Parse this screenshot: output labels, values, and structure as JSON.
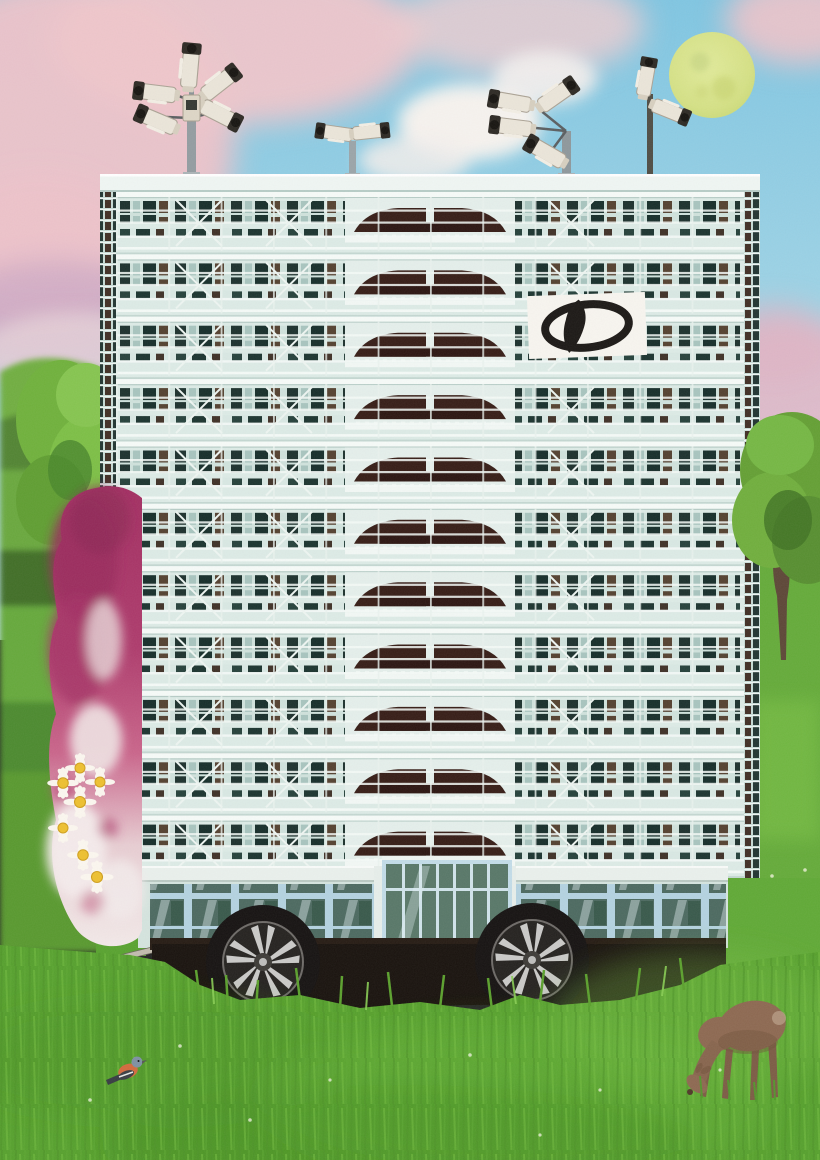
{
  "scene": {
    "building_floors": 11,
    "camera_clusters": 4,
    "cameras_per_cluster": [
      5,
      2,
      4,
      2
    ],
    "wheels": 2,
    "daisies": 7,
    "animals": [
      "deer",
      "songbird"
    ]
  },
  "colors": {
    "sky_top": "#7fc6e2",
    "sky_bottom": "#bfe2ea",
    "cloud_pink": "#eec3c9",
    "cloud_white": "#f6f3ef",
    "cloud_purple": "#cfaac6",
    "moon": "#d8e281",
    "hill_green": "#6fae41",
    "tree_green": "#6fb13b",
    "trunk_brown": "#5c4636",
    "distant_purple": "#84718f",
    "grass_base": "#55a02c",
    "grass_light": "#7cc24a",
    "building_base": "#dcebe6",
    "building_rail": "#f6fbf8",
    "window_dark": "#1b302c",
    "window_brown": "#53402f",
    "center_maroon": "#351c15",
    "logo_bg": "#f7f5ef",
    "logo_ink": "#1a1714",
    "frame_blue": "#b3d2e0",
    "glass_teal": "#4b695f",
    "chassis_black": "#17110c",
    "tire_black": "#141110",
    "rim_silver": "#c9c9c7",
    "garland_magenta": "#a22e61",
    "garland_white": "#f2e9e8",
    "daisy_yellow": "#edc02e",
    "deer_brown": "#8c6850",
    "bird_orange": "#d2693c",
    "bird_head": "#7d90a2",
    "camera_body": "#eae5d9",
    "camera_lens": "#2c2923",
    "pole_grey": "#929ca0"
  }
}
